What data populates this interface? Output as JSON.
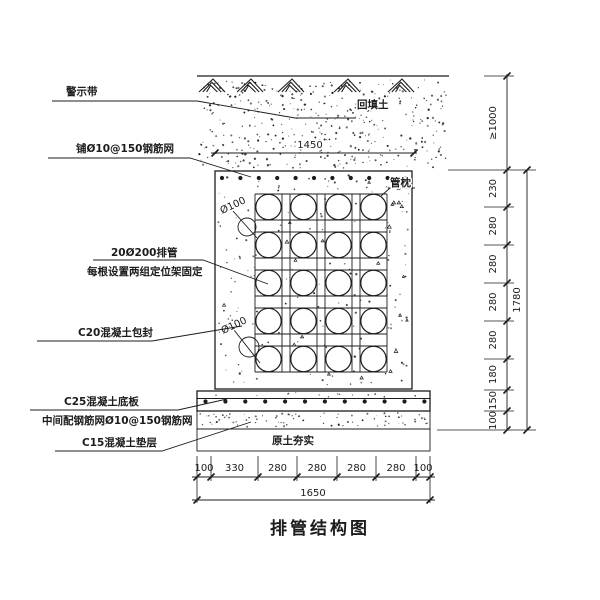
{
  "title": "排管结构图",
  "annotations": {
    "warning_tape": "警示带",
    "top_mesh": "铺Ø10@150钢筋网",
    "pipes_line1": "20Ø200排管",
    "pipes_line2": "每根设置两组定位架固定",
    "encapsulation": "C20混凝土包封",
    "base_slab": "C25混凝土底板",
    "slab_mesh": "中间配钢筋网Ø10@150钢筋网",
    "cushion": "C15混凝土垫层",
    "backfill": "回填土",
    "pipe_pillow": "管枕",
    "compacted_soil": "原土夯实",
    "pipe_diameter_upper": "Ø100",
    "pipe_diameter_lower": "Ø100"
  },
  "dimensions": {
    "top_width": "1450",
    "cover_depth": "≥1000",
    "right_segments": [
      "230",
      "280",
      "280",
      "280",
      "280",
      "180",
      "150",
      "100"
    ],
    "right_total": "1780",
    "bottom_segments": [
      "100",
      "330",
      "280",
      "280",
      "280",
      "280",
      "100"
    ],
    "bottom_total": "1650"
  },
  "drawing": {
    "line_color": "#1c1c1c",
    "background": "#ffffff",
    "pipe_rows": 5,
    "pipe_cols": 4
  }
}
